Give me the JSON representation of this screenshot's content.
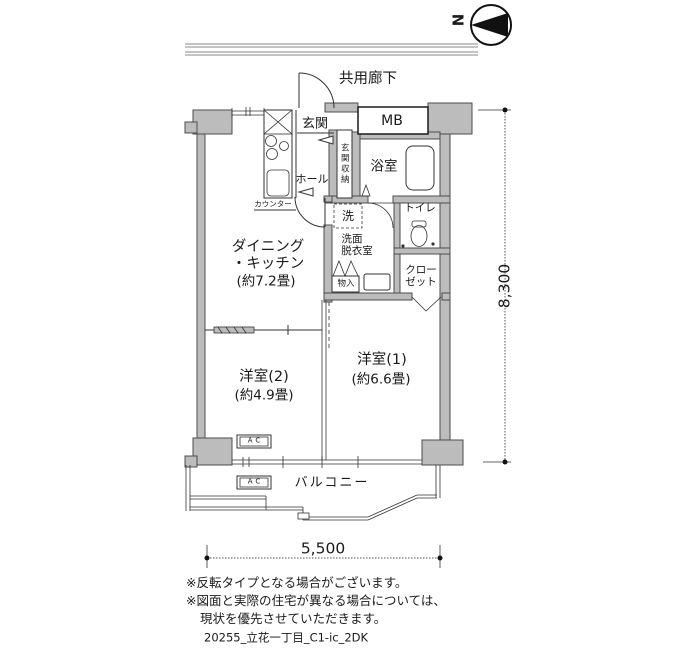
{
  "compass": {
    "label": "N"
  },
  "corridor": {
    "label": "共用廊下"
  },
  "rooms": {
    "genkan": {
      "label": "玄関"
    },
    "genkan_storage": {
      "label": "玄関収納"
    },
    "hall": {
      "label": "ホール"
    },
    "mb": {
      "label": "MB"
    },
    "bath": {
      "label": "浴室"
    },
    "washroom": {
      "line1": "洗面",
      "line2": "脱衣室"
    },
    "toilet": {
      "label": "トイレ"
    },
    "closet": {
      "line1": "クロー",
      "line2": "ゼット"
    },
    "monoire": {
      "label": "物入"
    },
    "dk": {
      "line1": "ダイニング",
      "line2": "・キッチン",
      "line3": "(約7.2畳)"
    },
    "room2": {
      "line1": "洋室(2)",
      "line2": "(約4.9畳)"
    },
    "room1": {
      "line1": "洋室(1)",
      "line2": "(約6.6畳)"
    },
    "balcony": {
      "label": "バルコニー"
    }
  },
  "fixtures": {
    "counter": {
      "label": "カウンター"
    },
    "washer": {
      "label": "洗"
    },
    "ac": {
      "label": "AC"
    }
  },
  "dimensions": {
    "width": "5,500",
    "height": "8,300"
  },
  "notes": [
    "※反転タイプとなる場合がございます。",
    "※図面と実際の住宅が異なる場合については、",
    "現状を優先させていただきます。"
  ],
  "plan_id": "20255_立花一丁目_C1-ic_2DK",
  "colors": {
    "wall": "#bcbcbc",
    "line": "#333333",
    "background": "#ffffff"
  }
}
